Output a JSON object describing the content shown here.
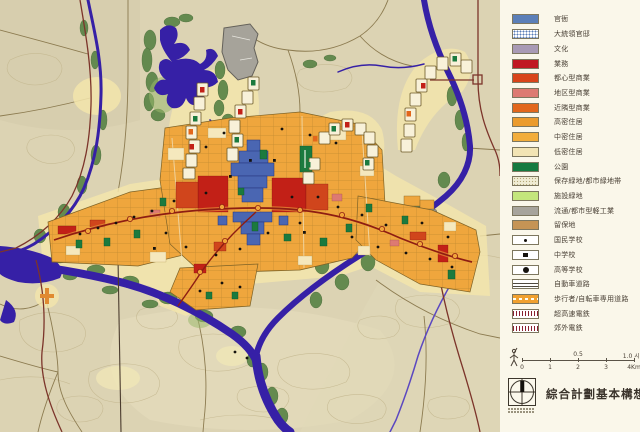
{
  "legend": {
    "items": [
      {
        "label": "官衙",
        "color": "#5b7fb8",
        "pattern": "solid"
      },
      {
        "label": "大統領官邸",
        "color": "#ffffff",
        "pattern": "blue-dots"
      },
      {
        "label": "文化",
        "color": "#a89ab5",
        "pattern": "solid"
      },
      {
        "label": "業務",
        "color": "#c01822",
        "pattern": "solid"
      },
      {
        "label": "都心型商業",
        "color": "#d8441a",
        "pattern": "solid"
      },
      {
        "label": "地区型商業",
        "color": "#dd7a72",
        "pattern": "solid"
      },
      {
        "label": "近隣型商業",
        "color": "#e2671c",
        "pattern": "solid"
      },
      {
        "label": "高密住居",
        "color": "#eb9b2d",
        "pattern": "solid"
      },
      {
        "label": "中密住居",
        "color": "#f2ad3b",
        "pattern": "solid"
      },
      {
        "label": "低密住居",
        "color": "#f2e4b4",
        "pattern": "solid"
      },
      {
        "label": "公園",
        "color": "#157a40",
        "pattern": "solid"
      },
      {
        "label": "保存緑地/都市緑地帯",
        "color": "#f0ecd4",
        "pattern": "speckle"
      },
      {
        "label": "施設緑地",
        "color": "#c4e67c",
        "pattern": "solid"
      },
      {
        "label": "流通/都市型軽工業",
        "color": "#a7a49c",
        "pattern": "solid"
      },
      {
        "label": "留保地",
        "color": "#c59455",
        "pattern": "solid"
      },
      {
        "label": "国民学校",
        "color": "#ffffff",
        "pattern": "dot-small"
      },
      {
        "label": "中学校",
        "color": "#ffffff",
        "pattern": "square"
      },
      {
        "label": "高等学校",
        "color": "#ffffff",
        "pattern": "dot-large"
      },
      {
        "label": "自動車道路",
        "color": "#ffffff",
        "pattern": "double-line"
      },
      {
        "label": "歩行者/自転車専用道路",
        "color": "#f0a030",
        "pattern": "ped-path"
      },
      {
        "label": "超高速電鉄",
        "color": "#ffffff",
        "pattern": "rail-ticks"
      },
      {
        "label": "郊外電鉄",
        "color": "#ffffff",
        "pattern": "rail-ticks"
      }
    ]
  },
  "scale": {
    "upper": [
      "0.5",
      "1.0 시간"
    ],
    "lower": [
      "0",
      "1",
      "2",
      "3",
      "4Km"
    ]
  },
  "footer": {
    "title": "綜合計劃基本構想"
  }
}
